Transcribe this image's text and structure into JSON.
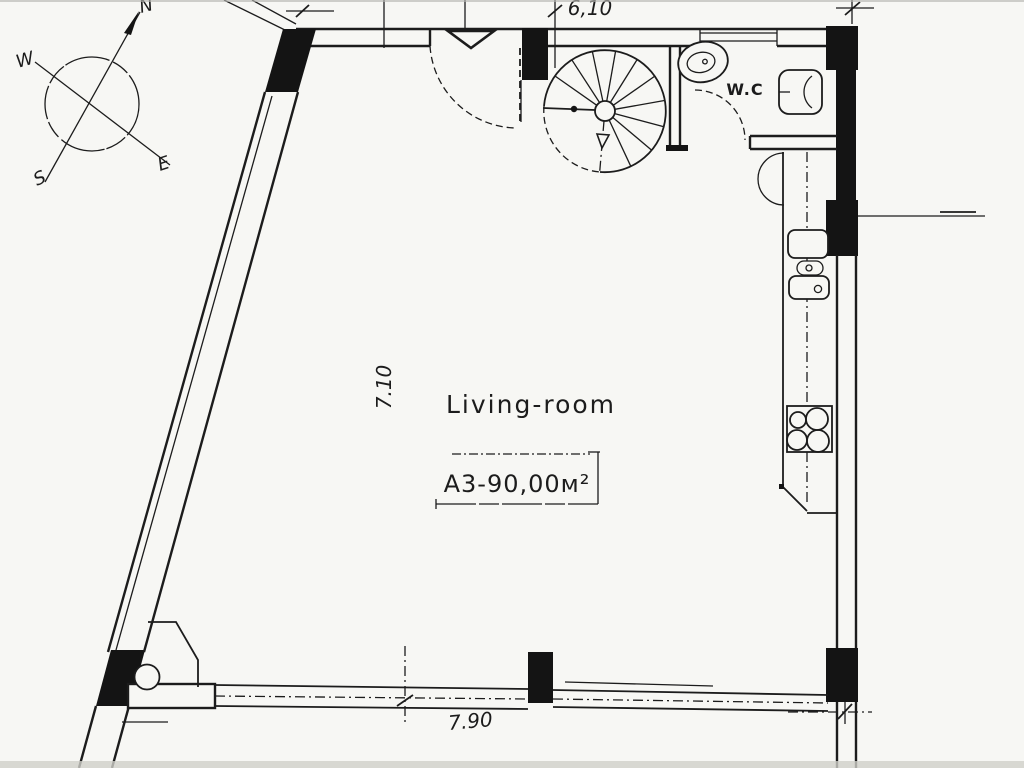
{
  "drawing": {
    "room_label": "Living-room",
    "area_label": "A3-90,00м²",
    "wc_label": "W.C",
    "dimensions": {
      "top_width": "6,10",
      "room_depth": "7.10",
      "bottom_width": "7.90"
    },
    "compass": {
      "north": "N",
      "west": "W",
      "south": "S",
      "east": "E"
    },
    "colors": {
      "ink": "#1c1c1c",
      "paper": "#f7f7f4"
    }
  }
}
